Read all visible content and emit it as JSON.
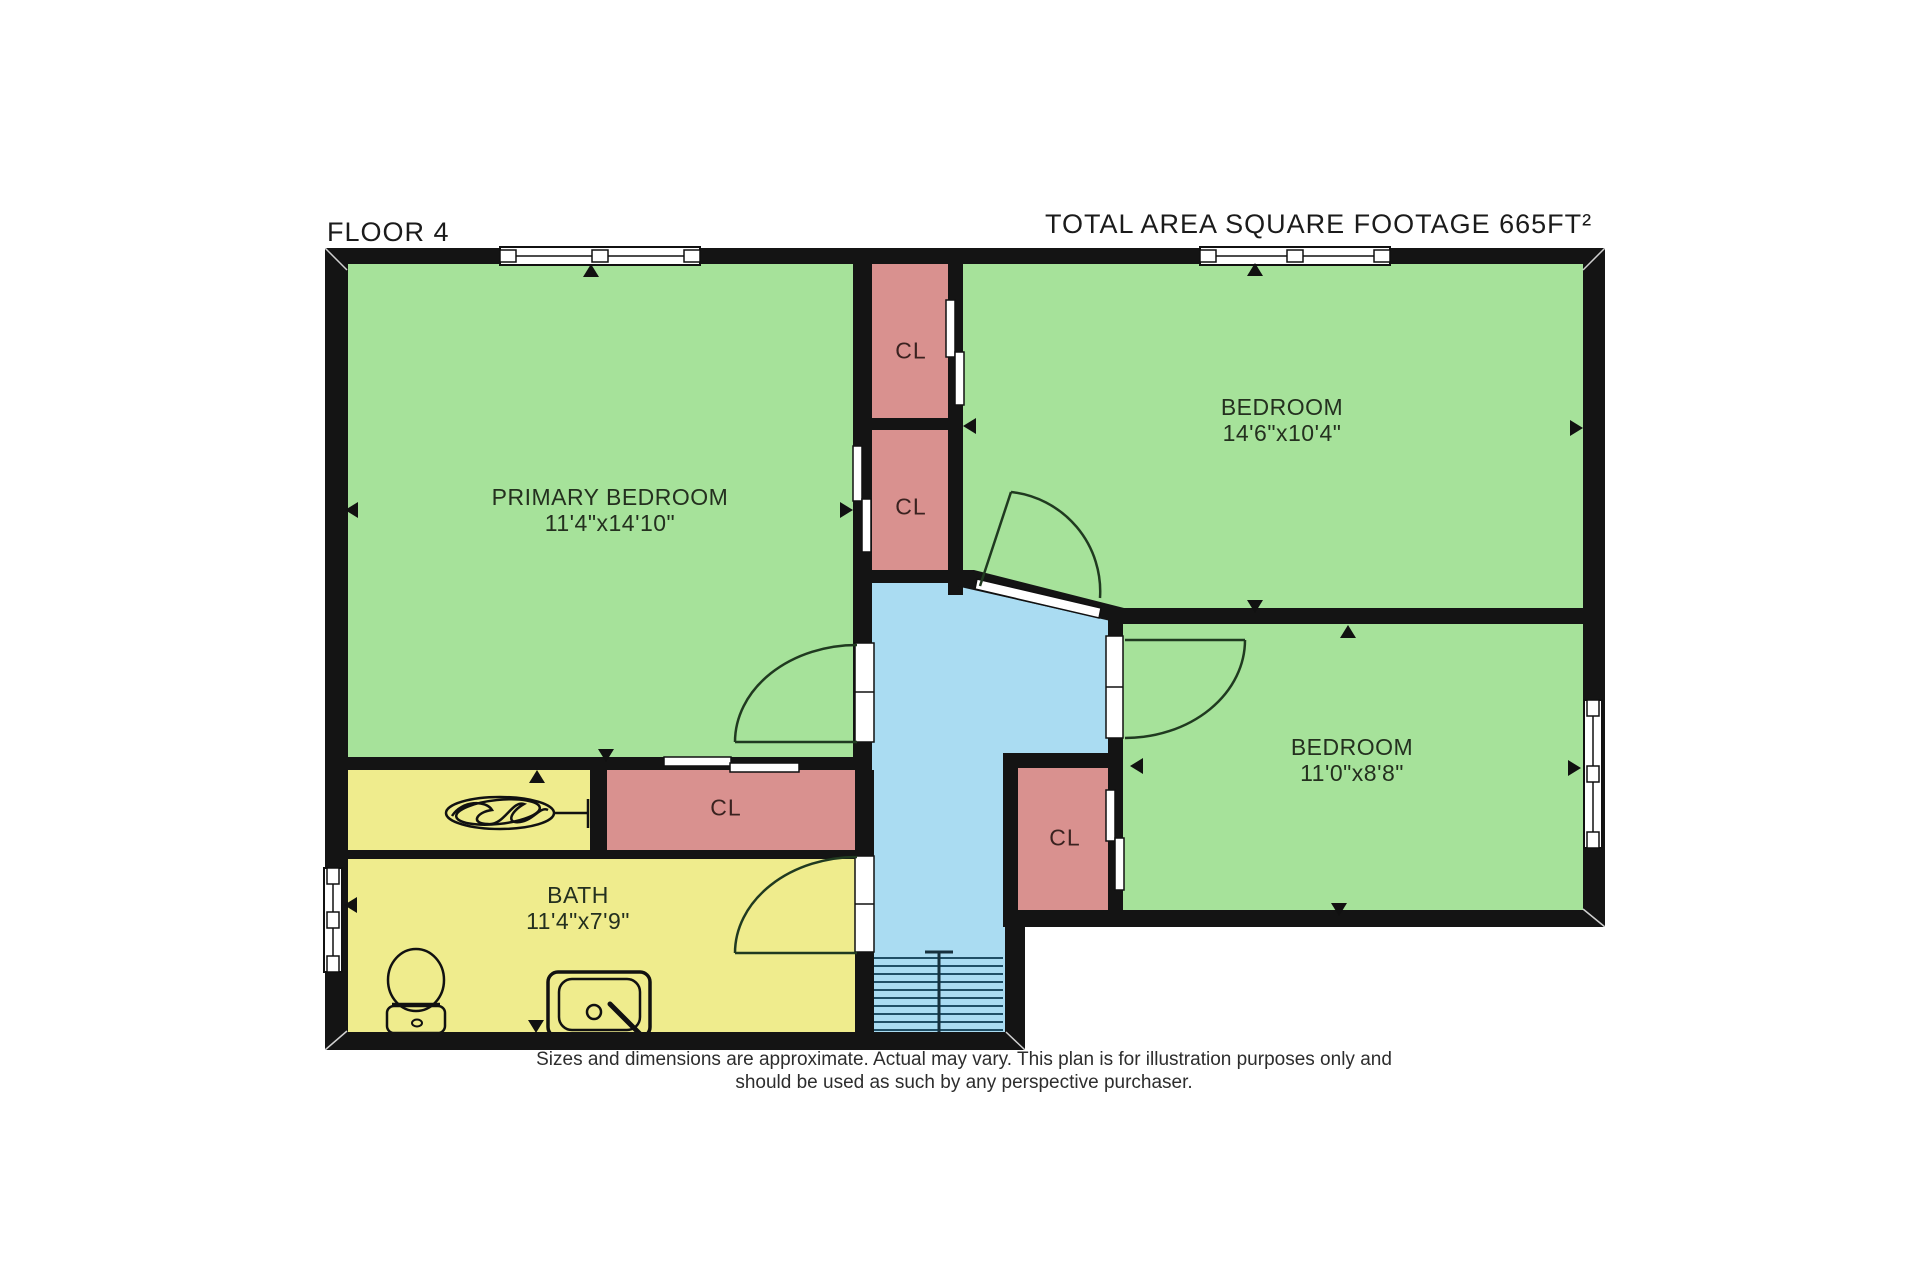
{
  "header": {
    "floor_label": "FLOOR 4",
    "total_area_label": "TOTAL AREA SQUARE FOOTAGE 665FT²"
  },
  "rooms": [
    {
      "id": "primary-bedroom",
      "name": "PRIMARY BEDROOM",
      "dimensions": "11'4\"x14'10\"",
      "color": "#a6e29a"
    },
    {
      "id": "bedroom-top-right",
      "name": "BEDROOM",
      "dimensions": "14'6\"x10'4\"",
      "color": "#a6e29a"
    },
    {
      "id": "bedroom-right",
      "name": "BEDROOM",
      "dimensions": "11'0\"x8'8\"",
      "color": "#a6e29a"
    },
    {
      "id": "bath",
      "name": "BATH",
      "dimensions": "11'4\"x7'9\"",
      "color": "#efec8d"
    }
  ],
  "closets": [
    {
      "id": "closet-top",
      "label": "CL"
    },
    {
      "id": "closet-middle",
      "label": "CL"
    },
    {
      "id": "closet-bottom-middle",
      "label": "CL"
    },
    {
      "id": "closet-right",
      "label": "CL"
    }
  ],
  "hallway": {
    "color": "#aadcf2"
  },
  "palette": {
    "wall": "#141414",
    "closet_fill": "#d9918f",
    "stair_tread": "#1f4f66"
  },
  "disclaimer": {
    "line1": "Sizes and dimensions are approximate. Actual may vary. This plan is for illustration purposes only and",
    "line2": "should be used as such by any perspective purchaser."
  }
}
